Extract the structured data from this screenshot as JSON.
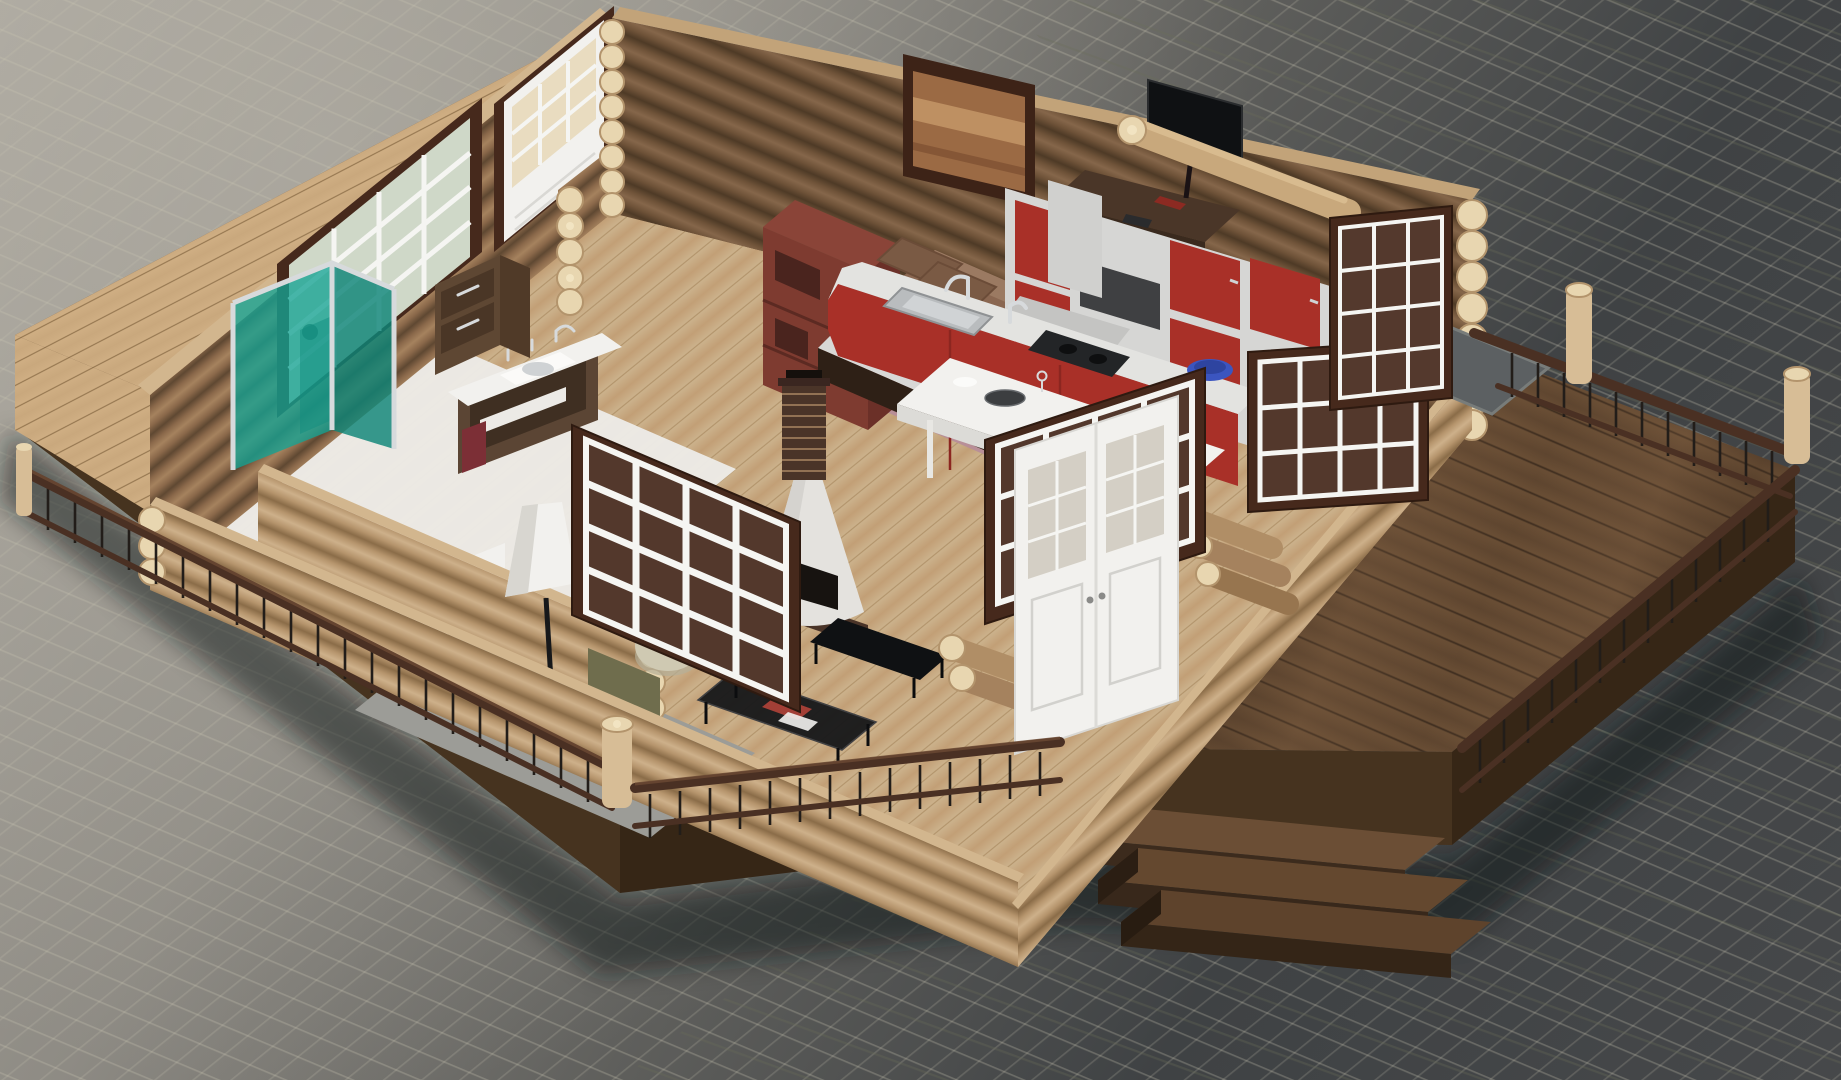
{
  "scene": {
    "type": "3d-architectural-render",
    "description": "Isometric cutaway 3D render of a single-storey log cabin interior standing on a dark wooden deck over gray cobblestone pavement",
    "style": "photorealistic roofless cutaway model, viewed from above at an angle",
    "rooms": [
      {
        "name": "bathroom",
        "position": "left",
        "items": [
          "teal-glass-shower",
          "white-vanity-sink",
          "chest-of-drawers",
          "toilet",
          "grid-window"
        ]
      },
      {
        "name": "living-room",
        "position": "front-left",
        "items": [
          "fireplace-with-brick-chimney",
          "floor-lamp",
          "olive-armchair",
          "beige-pouf",
          "black-glass-coffee-table",
          "tv-bench",
          "gray-rug",
          "large-grid-window"
        ]
      },
      {
        "name": "bedroom",
        "position": "back-center",
        "items": [
          "double-bed-brown-duvet",
          "dark-red-bookshelf",
          "mauve-rug",
          "wall-mirror",
          "desk-with-monitor"
        ]
      },
      {
        "name": "kitchen-dining",
        "position": "right",
        "items": [
          "red-kitchen-cabinets",
          "cooker-hood",
          "steel-sink-chrome-faucet",
          "dark-cooktop",
          "blue-bowl",
          "white-dining-table",
          "bar-stools",
          "dark-plates",
          "wine-glasses"
        ]
      },
      {
        "name": "deck-terrace",
        "position": "perimeter",
        "items": [
          "log-post-railings",
          "metal-balusters",
          "three-wooden-steps",
          "white-double-door",
          "standing-grid-windows",
          "gray-stone-mat",
          "spare-logs"
        ]
      }
    ],
    "materials": {
      "walls": "stacked round timber logs with visible end grain",
      "floor_interior": "light oak planks",
      "floor_bathroom": "white tile",
      "deck": "dark weathered wood planks",
      "ground": "gray cobblestone setts, darker slate at right"
    }
  },
  "palette": {
    "ground_light": "#a8a49c",
    "ground_dark": "#3a3d3f",
    "grout": "#c9c5b2",
    "slate_line": "#6a6d58",
    "deck_top": "#5e452f",
    "deck_face": "#46331f",
    "deck_face_dark": "#362616",
    "porch_light": "#c9a87d",
    "log_hi": "#d2b68e",
    "log_mid": "#b3916a",
    "log_sh": "#7c5f43",
    "log_end": "#e8d6b0",
    "log_end_ring": "#b3946c",
    "log_end_core": "#f2e4c2",
    "floor_tan": "#cbb18b",
    "bath_floor": "#eceae6",
    "rug_gray": "#9c9c97",
    "rug_pink": "#b78d99",
    "teal": "#14a394",
    "teal_dark": "#0d8577",
    "chrome": "#d7dadc",
    "white": "#f2f1ee",
    "off_white": "#dcdbd7",
    "brown_wood": "#5b4534",
    "brown_dark": "#3f2f22",
    "red_cab": "#a93028",
    "red_cab_dark": "#8c2620",
    "carcass": "#d6d6d4",
    "counter_top": "#e3e3e0",
    "blue_bowl": "#3b55c0",
    "near_black": "#17181a",
    "olive": "#6f6d4d",
    "olive_dark": "#55533a",
    "cushion_red": "#5d3038",
    "pouf": "#cfc9b2",
    "brick": "#4a3428",
    "mortar": "#c9a377",
    "hearth_white": "#e4e2de",
    "firebox": "#171310",
    "frame_dark": "#46291c",
    "glaze_white": "#f5f5f2",
    "glass_warm": "#e9dcc0",
    "glass_green": "#cfd8c8",
    "rail_wood": "#4a3023",
    "baluster": "#221d19",
    "post_log": "#d7bd96",
    "tv_black": "#0f1113",
    "book_red": "#a33f36",
    "bin_red": "#7c2f36",
    "mat_stone": "#5c6062",
    "duvet": "#8a6751",
    "pillow": "#7a5a44",
    "mattress": "#d8d8d6",
    "bed_frame": "#2e2016",
    "shelf_red": "#7e3b30",
    "shelf_red_top": "#8a4438",
    "shelf_red_side": "#6b3028",
    "shelf_dark": "#4a241e",
    "mirror_wood": "#9b6a44"
  }
}
